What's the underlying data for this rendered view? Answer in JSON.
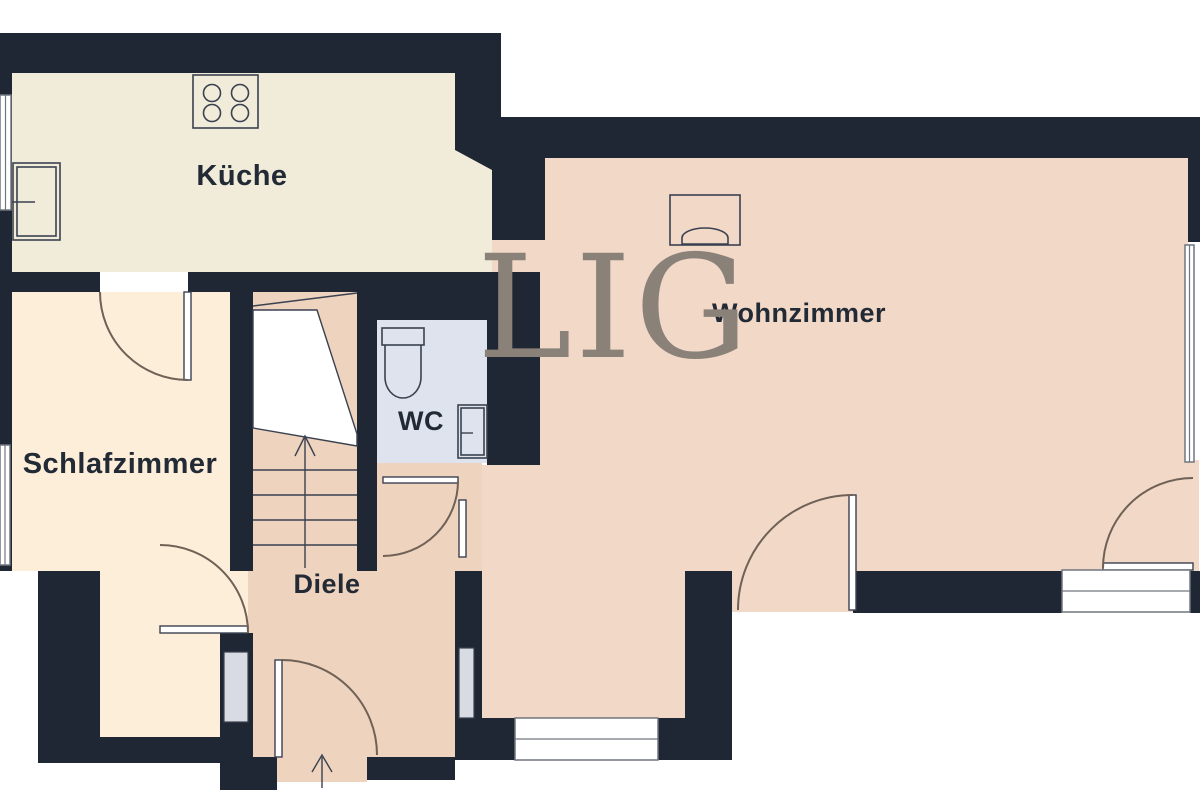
{
  "plan": {
    "type": "floorplan",
    "watermark": {
      "text": "LIG",
      "color": "#8a8178"
    },
    "rooms": {
      "kueche": {
        "label": "Küche"
      },
      "wohnzimmer": {
        "label": "Wohnzimmer"
      },
      "schlafzimmer": {
        "label": "Schlafzimmer"
      },
      "wc": {
        "label": "WC"
      },
      "diele": {
        "label": "Diele"
      }
    },
    "colors": {
      "walls": "#1e2733",
      "background": "#ffffff",
      "kueche_floor": "#f1ecd9",
      "schlafzimmer_floor": "#fdeeda",
      "wohnzimmer_floor": "#f2d8c7",
      "diele_floor": "#eed3bf",
      "wc_floor": "#dfe3ee",
      "stair_cut": "#ffffff",
      "fixture_outline": "#3a4150",
      "door_arc": "#6f6156"
    },
    "icons": [
      "stove-icon",
      "kitchen-sink-icon",
      "toilet-icon",
      "washbasin-icon",
      "tv-board-icon",
      "stairs-icon",
      "entrance-arrow-icon",
      "door-arc-icon",
      "window-icon"
    ]
  }
}
